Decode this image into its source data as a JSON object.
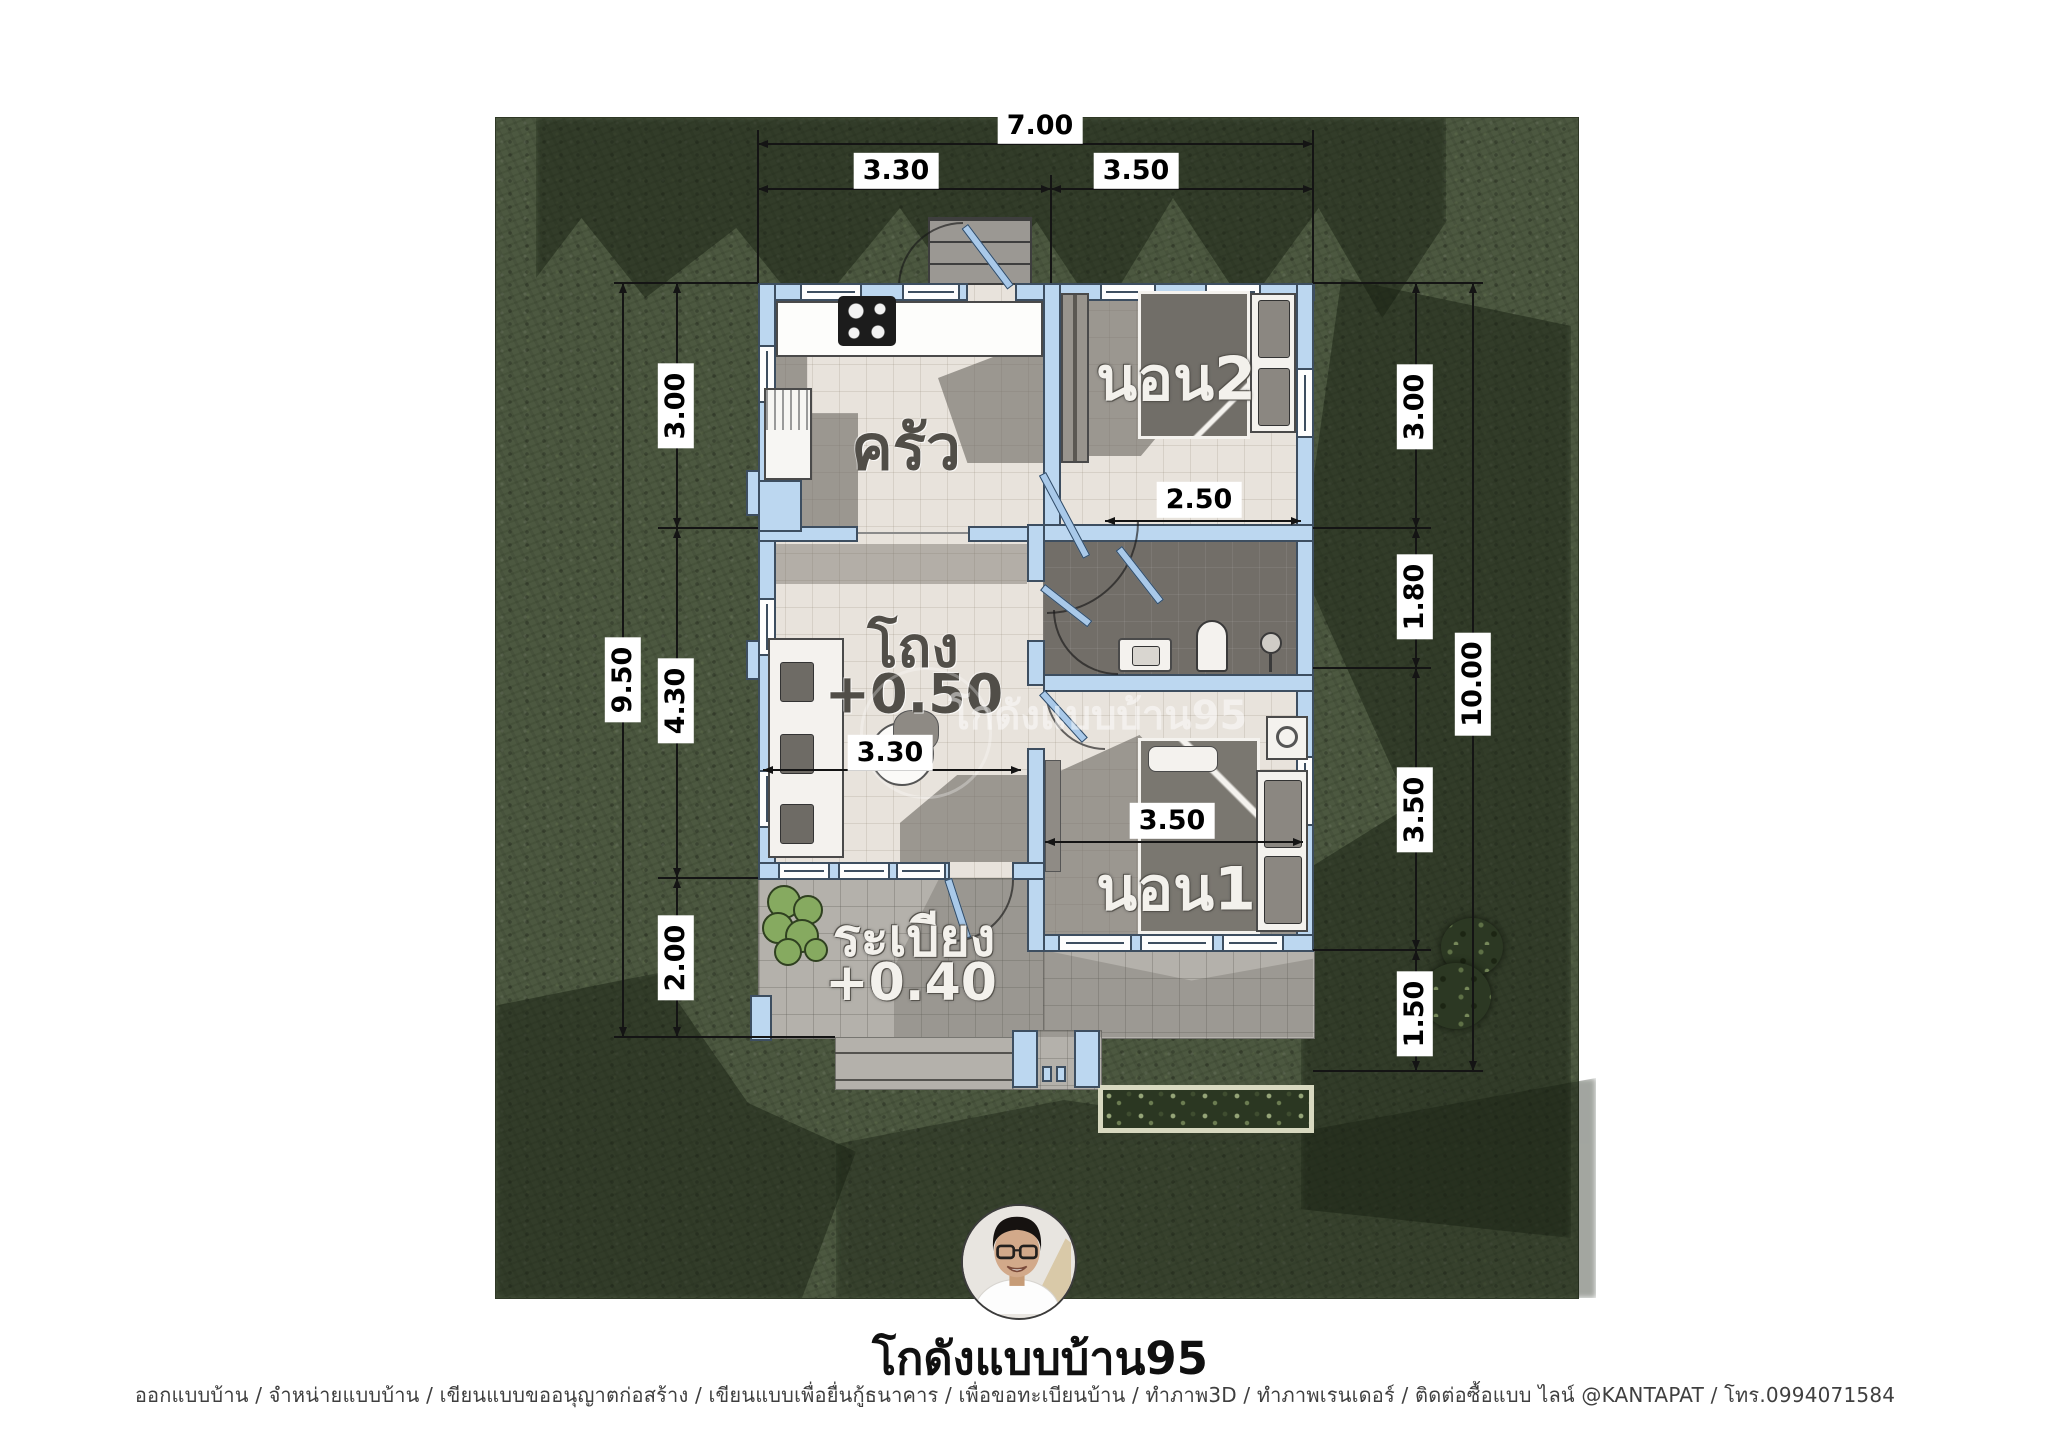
{
  "rooms": {
    "kitchen": "ครัว",
    "bedroom2": "นอน2",
    "hall": "โถง",
    "hall_level": "+0.50",
    "bedroom1": "นอน1",
    "terrace": "ระเบียง",
    "terrace_level": "+0.40"
  },
  "dims": {
    "top": {
      "total": "7.00",
      "left": "3.30",
      "right": "3.50"
    },
    "left": {
      "total": "9.50",
      "segments": [
        "3.00",
        "4.30",
        "2.00"
      ]
    },
    "right": {
      "total": "10.00",
      "segments": [
        "3.00",
        "1.80",
        "3.50",
        "1.50"
      ]
    },
    "interior": {
      "bedroom2_width": "2.50",
      "hall_width": "3.30",
      "bedroom1_width": "3.50"
    }
  },
  "watermark": {
    "text": "โกดังแบบบ้าน95"
  },
  "branding": {
    "name": "โกดังแบบบ้าน95"
  },
  "footer": {
    "credit": "ออกแบบบ้าน / จำหน่ายแบบบ้าน / เขียนแบบขออนุญาตก่อสร้าง / เขียนแบบเพื่อยื่นกู้ธนาคาร / เพื่อขอทะเบียนบ้าน / ทำภาพ3D / ทำภาพเรนเดอร์ / ติดต่อซื้อแบบ ไลน์ @KANTAPAT / โทร.0994071584"
  },
  "colors": {
    "grass": "#4c5840",
    "wall": "#bcd7f0",
    "wall_outline": "#3d4e60",
    "floor": "#e8e3dc",
    "terrace": "#b4b1ab",
    "bathroom_floor": "#726e68",
    "interior_shadow": "#6e6b65",
    "dimension_line": "#141414",
    "label_background": "#ffffff"
  }
}
